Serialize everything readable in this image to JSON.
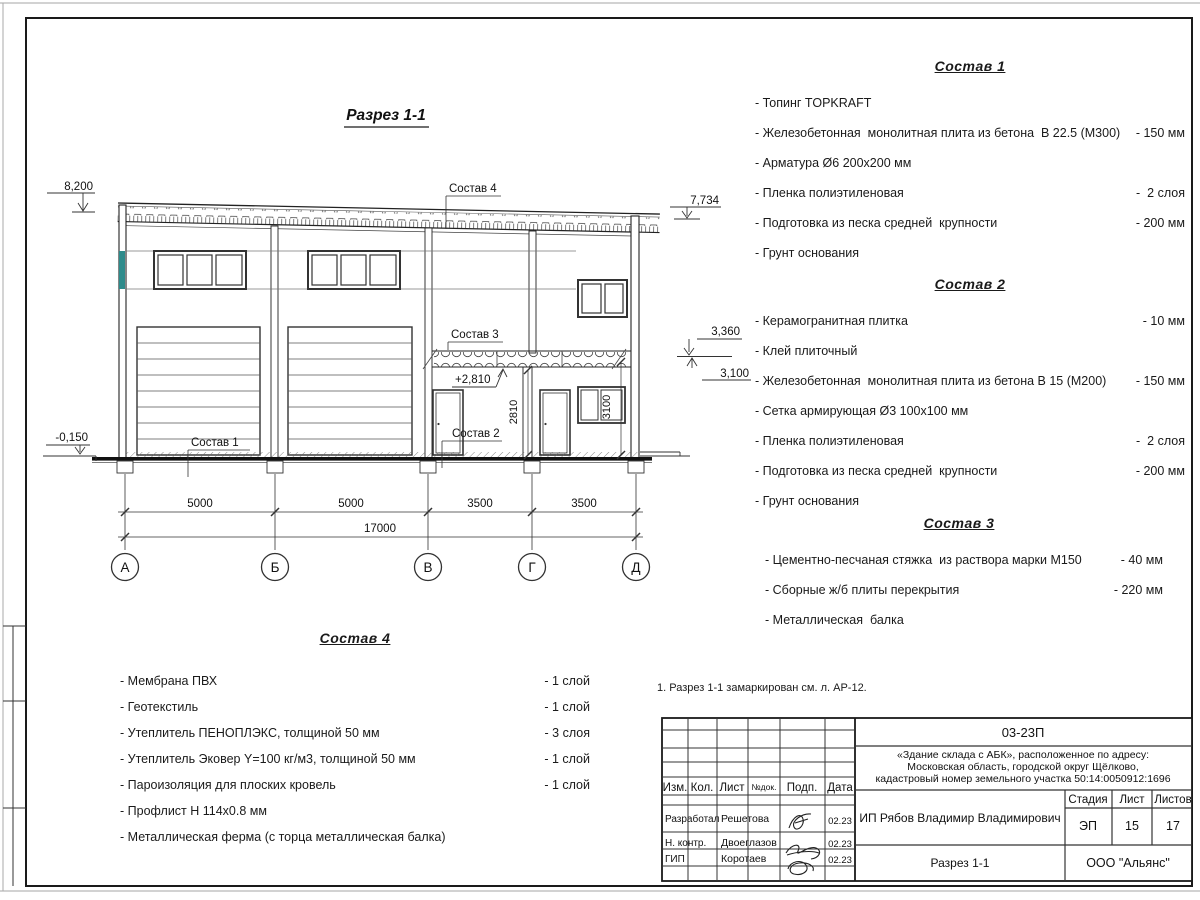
{
  "section": {
    "title": "Разрез 1-1",
    "axes": [
      "А",
      "Б",
      "В",
      "Г",
      "Д"
    ],
    "dims": {
      "d1": "5000",
      "d2": "5000",
      "d3": "3500",
      "d4": "3500",
      "total": "17000",
      "h_2810": "2810",
      "h_3100": "3100"
    },
    "levels": {
      "roof_left": "8,200",
      "ground": "-0,150",
      "roof_right": "7,734",
      "l3360": "3,360",
      "l3100": "3,100",
      "slab": "+2,810"
    },
    "callouts": {
      "c1": "Состав  1",
      "c2": "Состав  2",
      "c3": "Состав  3",
      "c4": "Состав 4"
    }
  },
  "note": "1. Разрез 1-1 замаркирован см. л. АР-12.",
  "compositions": [
    {
      "title": "Состав 1",
      "items": [
        {
          "text": "- Топинг TOPKRAFT",
          "value": ""
        },
        {
          "text": "- Железобетонная  монолитная плита из бетона  В 22.5 (М300)",
          "value": "- 150 мм"
        },
        {
          "text": "- Арматура Ø6 200х200 мм",
          "value": ""
        },
        {
          "text": "- Пленка полиэтиленовая",
          "value": "-  2 слоя"
        },
        {
          "text": "- Подготовка из песка средней  крупности",
          "value": "- 200 мм"
        },
        {
          "text": "- Грунт основания",
          "value": ""
        }
      ]
    },
    {
      "title": "Состав 2",
      "items": [
        {
          "text": "- Керамогранитная плитка",
          "value": "- 10 мм"
        },
        {
          "text": "- Клей плиточный",
          "value": ""
        },
        {
          "text": "- Железобетонная  монолитная плита из бетона В 15 (М200)",
          "value": "- 150 мм"
        },
        {
          "text": "- Сетка армирующая Ø3 100х100 мм",
          "value": ""
        },
        {
          "text": "- Пленка полиэтиленовая",
          "value": "-  2 слоя"
        },
        {
          "text": "- Подготовка из песка средней  крупности",
          "value": "- 200 мм"
        },
        {
          "text": "- Грунт основания",
          "value": ""
        }
      ]
    },
    {
      "title": "Состав 3",
      "items": [
        {
          "text": "- Цементно-песчаная стяжка  из раствора марки М150",
          "value": "- 40 мм"
        },
        {
          "text": "- Сборные ж/б плиты перекрытия",
          "value": "- 220 мм"
        },
        {
          "text": "- Металлическая  балка",
          "value": ""
        }
      ]
    },
    {
      "title": "Состав 4",
      "items": [
        {
          "text": "- Мембрана ПВХ",
          "value": "- 1 слой"
        },
        {
          "text": "- Геотекстиль",
          "value": "- 1 слой"
        },
        {
          "text": "- Утеплитель ПЕНОПЛЭКС, толщиной 50 мм",
          "value": "- 3 слоя"
        },
        {
          "text": "- Утеплитель Эковер Y=100 кг/м3, толщиной 50 мм",
          "value": "- 1 слой"
        },
        {
          "text": "- Пароизоляция для плоских кровель",
          "value": "- 1 слой"
        },
        {
          "text": "- Профлист Н 114х0.8 мм",
          "value": ""
        },
        {
          "text": "- Металлическая ферма (с торца металлическая балка)",
          "value": ""
        }
      ]
    }
  ],
  "title_block": {
    "doc_number": "03-23П",
    "project_line1": "«Здание склада с АБК», расположенное по адресу:",
    "project_line2": "Московская область, городской округ Щёлково,",
    "project_line3": "кадастровый номер земельного участка 50:14:0050912:1696",
    "client": "ИП Рябов Владимир Владимирович",
    "sheet_title": "Разрез 1-1",
    "company": "ООО \"Альянс\"",
    "stage_label": "Стадия",
    "sheet_label": "Лист",
    "sheets_label": "Листов",
    "stage": "ЭП",
    "sheet_no": "15",
    "sheets_total": "17",
    "cols": {
      "izm": "Изм.",
      "kol": "Кол.",
      "list": "Лист",
      "ndok": "№док.",
      "podp": "Подп.",
      "data": "Дата"
    },
    "rows": [
      {
        "role": "Разработал",
        "name": "Решетова",
        "date": "02.23"
      },
      {
        "role": "Н. контр.",
        "name": "Двоеглазов",
        "date": "02.23"
      },
      {
        "role": "ГИП",
        "name": "Коротаев",
        "date": "02.23"
      }
    ]
  },
  "colors": {
    "accent_teal": "#2e8b8b",
    "line": "#1a1a1a"
  }
}
